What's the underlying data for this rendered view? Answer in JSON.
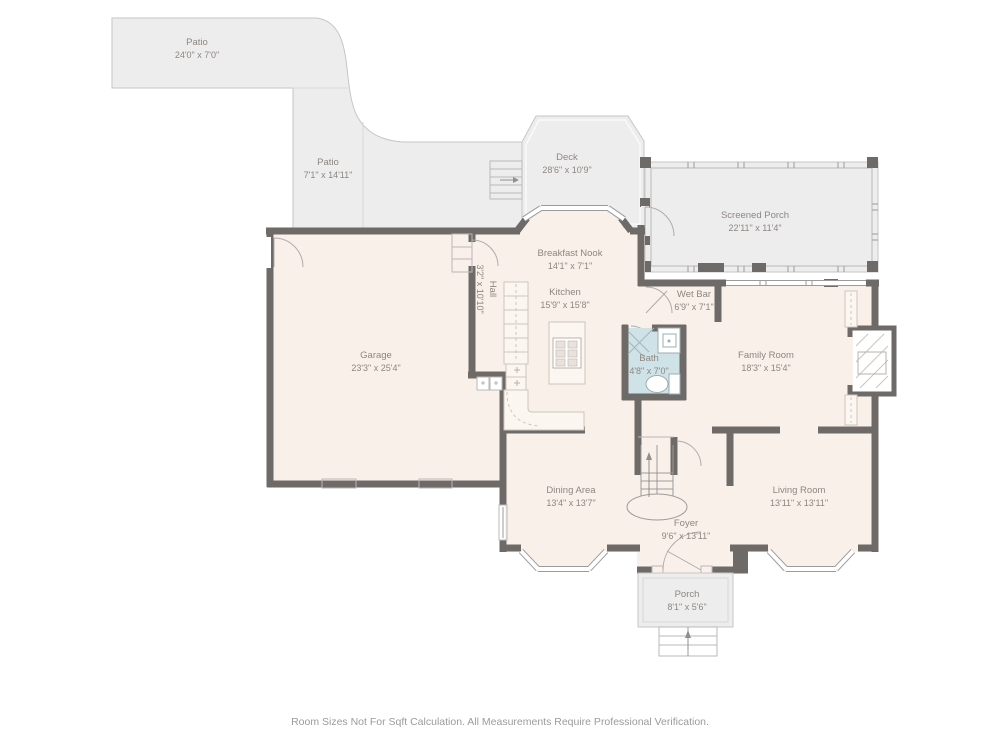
{
  "colors": {
    "wall": "#6e6a67",
    "floor": "#f9f0e9",
    "outdoor": "#ededed",
    "bath": "#cfe2e8",
    "cabinet": "#fbf6f0",
    "label": "#8d8781",
    "footer": "#9b9b9b"
  },
  "rooms": [
    {
      "id": "patio-top",
      "name": "Patio",
      "dims": "24'0\" x 7'0\""
    },
    {
      "id": "patio-side",
      "name": "Patio",
      "dims": "7'1\" x 14'11\""
    },
    {
      "id": "deck",
      "name": "Deck",
      "dims": "28'6\" x 10'9\""
    },
    {
      "id": "screened-porch",
      "name": "Screened Porch",
      "dims": "22'11\" x 11'4\""
    },
    {
      "id": "breakfast-nook",
      "name": "Breakfast Nook",
      "dims": "14'1\" x 7'1\""
    },
    {
      "id": "kitchen",
      "name": "Kitchen",
      "dims": "15'9\" x 15'8\""
    },
    {
      "id": "hall",
      "name": "Hall",
      "dims": "3'2\" x 10'10\""
    },
    {
      "id": "wet-bar",
      "name": "Wet Bar",
      "dims": "6'9\" x 7'1\""
    },
    {
      "id": "bath",
      "name": "Bath",
      "dims": "4'8\" x 7'0\""
    },
    {
      "id": "family-room",
      "name": "Family Room",
      "dims": "18'3\" x 15'4\""
    },
    {
      "id": "garage",
      "name": "Garage",
      "dims": "23'3\" x 25'4\""
    },
    {
      "id": "dining-area",
      "name": "Dining Area",
      "dims": "13'4\" x 13'7\""
    },
    {
      "id": "living-room",
      "name": "Living Room",
      "dims": "13'11\" x 13'11\""
    },
    {
      "id": "foyer",
      "name": "Foyer",
      "dims": "9'6\" x 13'11\""
    },
    {
      "id": "porch",
      "name": "Porch",
      "dims": "8'1\" x 5'6\""
    }
  ],
  "footer": {
    "text": "Room Sizes Not For Sqft Calculation. All Measurements Require Professional Verification."
  }
}
